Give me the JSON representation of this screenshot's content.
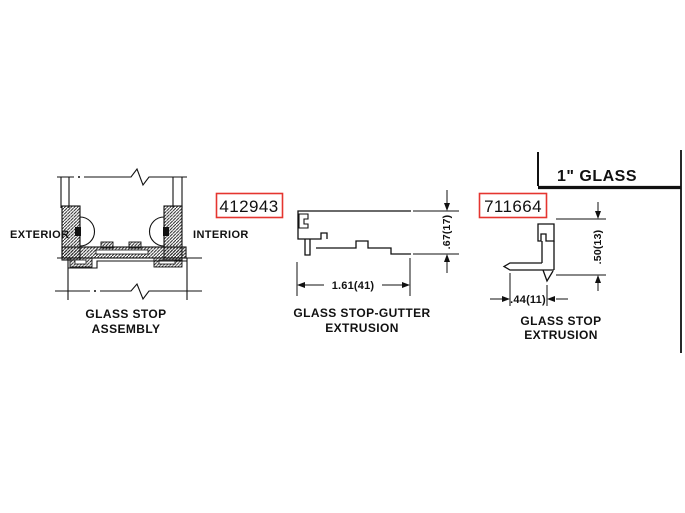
{
  "drawing": {
    "assembly": {
      "label_exterior": "EXTERIOR",
      "label_interior": "INTERIOR",
      "title_line1": "GLASS STOP",
      "title_line2": "ASSEMBLY"
    },
    "gutter_extrusion": {
      "part_number": "412943",
      "dim_height": ".67(17)",
      "dim_width": "1.61(41)",
      "title_line1": "GLASS STOP-GUTTER",
      "title_line2": "EXTRUSION"
    },
    "stop_extrusion": {
      "part_number": "711664",
      "dim_height": ".50(13)",
      "dim_width": ".44(11)",
      "title_line1": "GLASS STOP",
      "title_line2": "EXTRUSION"
    },
    "note_glass": "1\" GLASS",
    "colors": {
      "part_number_red": "#e53530",
      "line": "#111111",
      "background": "#ffffff"
    }
  }
}
